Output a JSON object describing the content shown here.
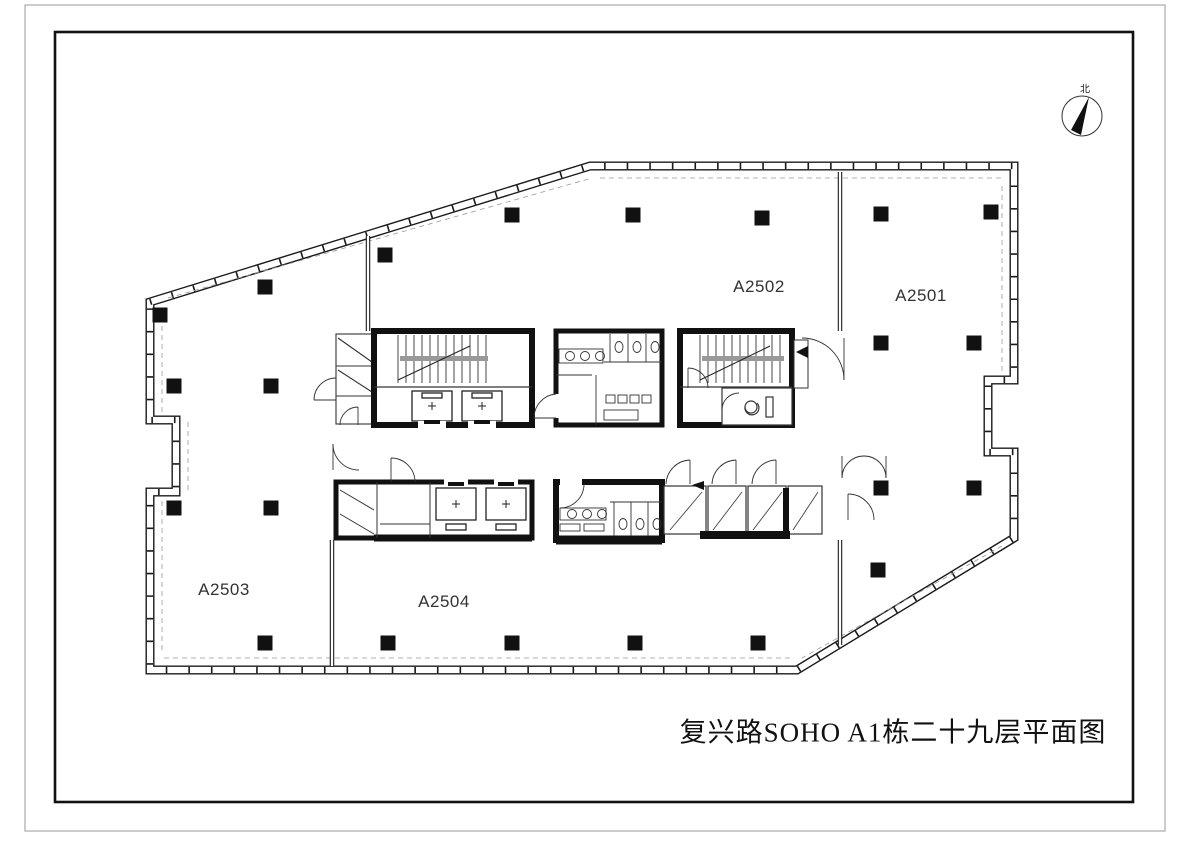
{
  "drawing": {
    "title": "复兴路SOHO A1栋二十九层平面图",
    "north_label": "北",
    "rooms": {
      "a2501": "A2501",
      "a2502": "A2502",
      "a2503": "A2503",
      "a2504": "A2504"
    },
    "colors": {
      "line": "#1a1a1a",
      "dashed": "#999999",
      "landing": "#999999"
    }
  }
}
